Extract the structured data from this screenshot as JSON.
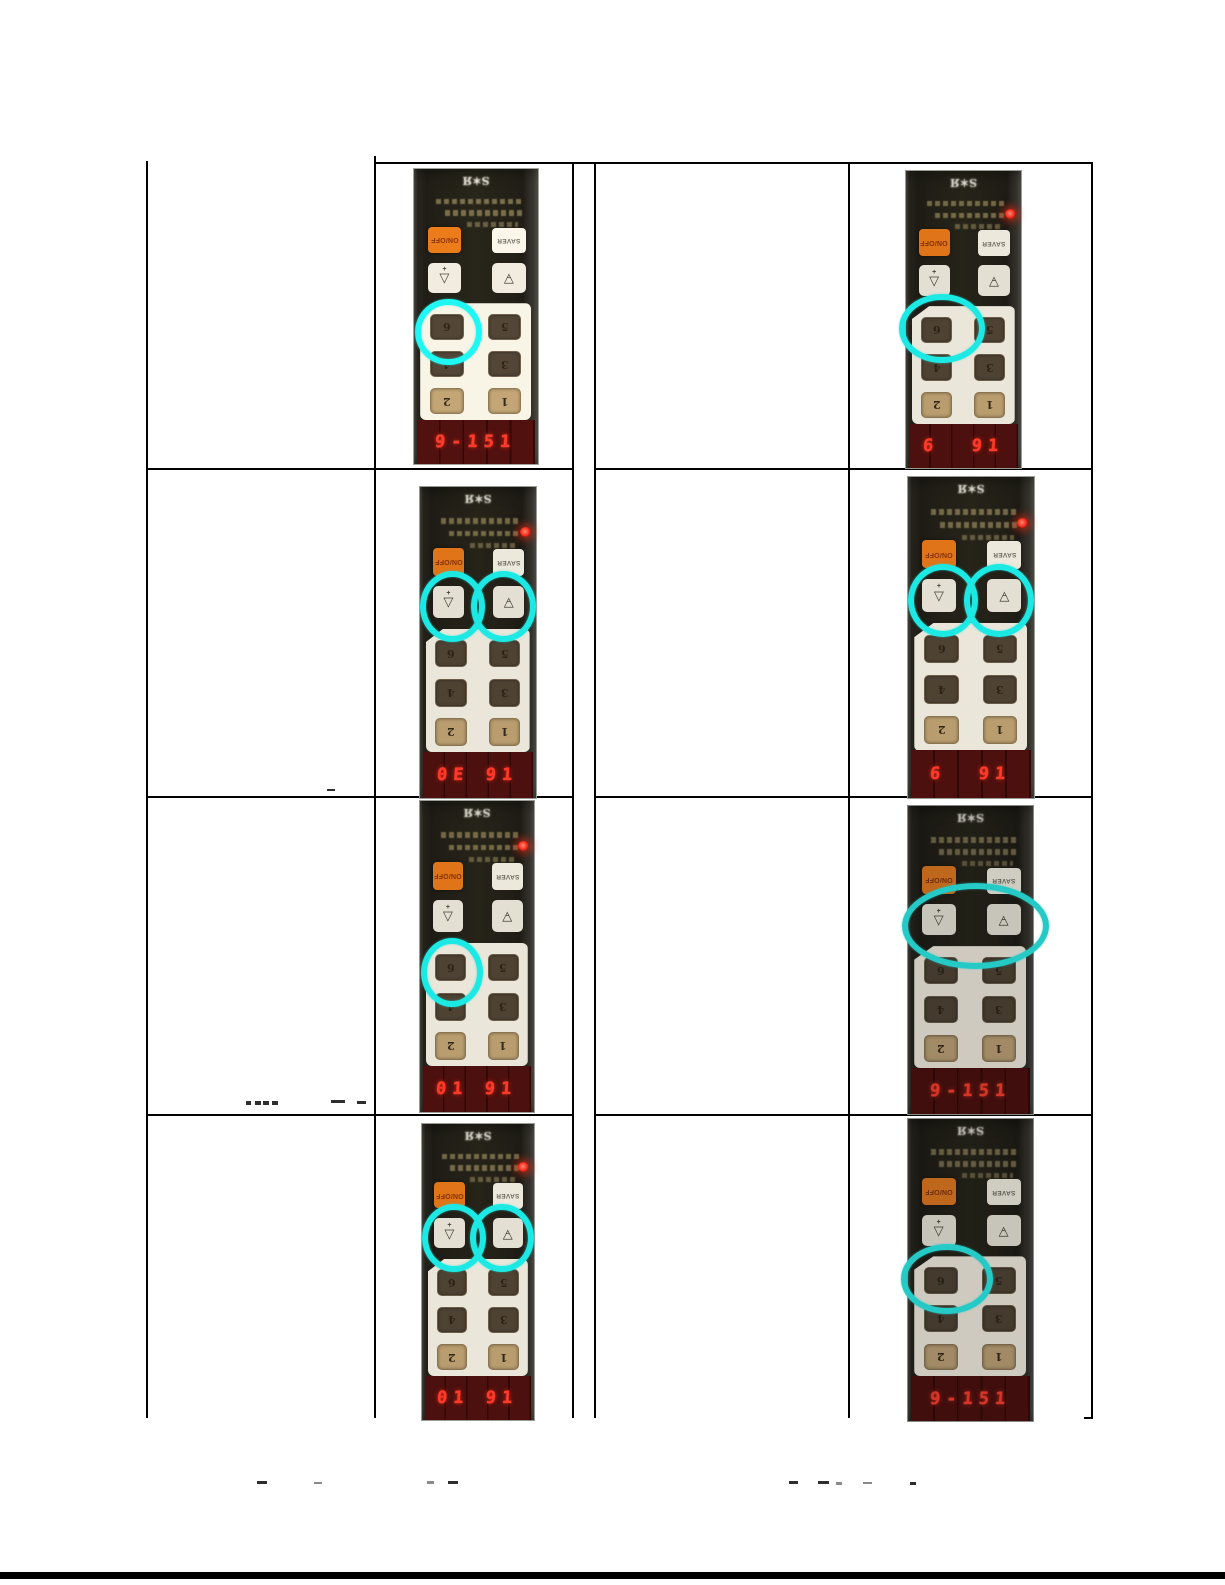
{
  "panel": {
    "on_off_label": "ON/OFF",
    "saver_label": "SAVER",
    "down_arrow_symbol": "▽",
    "down_arrow_mark": "+",
    "up_arrow_symbol": "△",
    "up_arrow_mark": "−",
    "keys": [
      "6",
      "5",
      "4",
      "3",
      "2",
      "1"
    ]
  },
  "icons": {
    "brand_logo_glyph": "S✶Я"
  },
  "colors": {
    "highlight_cyan": "#1de9e4",
    "led_red": "#ff2a1a",
    "display_red": "#ff382a",
    "onoff_orange": "#df7418",
    "keypad_beige": "#eae6d9",
    "display_background": "#4c100e"
  },
  "photos": [
    {
      "name": "photo-row1-left",
      "display": "9-151",
      "led": false,
      "highlight": "circle-key6"
    },
    {
      "name": "photo-row1-right",
      "display": "6  91",
      "led": true,
      "highlight": "ellipse-key6"
    },
    {
      "name": "photo-row2-left",
      "display": "0E 91",
      "led": true,
      "highlight": "circles-arrows"
    },
    {
      "name": "photo-row2-right",
      "display": "6  91",
      "led": true,
      "highlight": "circles-arrows"
    },
    {
      "name": "photo-row3-left",
      "display": "01 91",
      "led": true,
      "highlight": "circle-key6"
    },
    {
      "name": "photo-row3-right",
      "display": "9-151",
      "led": false,
      "highlight": "ellipse-arrows"
    },
    {
      "name": "photo-row4-left",
      "display": "01 91",
      "led": true,
      "highlight": "circles-arrows"
    },
    {
      "name": "photo-row4-right",
      "display": "9-151",
      "led": false,
      "highlight": "ellipse-key6"
    }
  ]
}
